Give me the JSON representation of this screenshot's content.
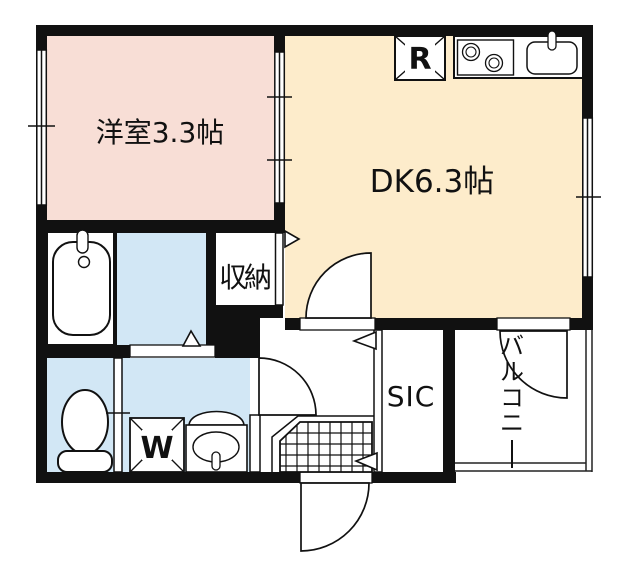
{
  "plan": {
    "type": "apartment-floor-plan",
    "labels": {
      "western_room": "洋室3.3帖",
      "dining_kitchen": "DK6.3帖",
      "closet": "収納",
      "shoe_closet": "SIC",
      "balcony": "バルコニー",
      "balcony_chars": [
        "バ",
        "ル",
        "コ",
        "ニ"
      ],
      "refrigerator": "R",
      "washing_machine": "W"
    },
    "colors": {
      "wall": "#111111",
      "western_room_floor": "#f8ded6",
      "dk_floor": "#fdeccb",
      "wet_area_floor": "#d2e7f5",
      "fixture_fill": "#ffffff",
      "railing": "#222222"
    }
  }
}
